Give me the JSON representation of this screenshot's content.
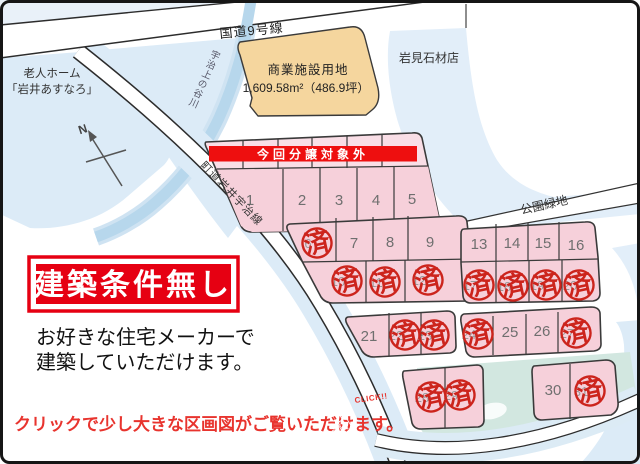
{
  "labels": {
    "route9": "国道9号線",
    "town_road": "町道岩井宇治線",
    "river": "宇治上の谷川",
    "nursing1": "老人ホーム",
    "nursing2": "「岩井あすなろ」",
    "stone_shop": "岩見石材店",
    "park": "公園緑地",
    "commercial_title": "商業施設用地",
    "commercial_area": "1,609.58m²（486.9坪）",
    "banner": "今回分譲対象外",
    "north": "N"
  },
  "promo": {
    "box": "建築条件無し",
    "line1": "お好きな住宅メーカーで",
    "line2": "建築していただけます。"
  },
  "footer": {
    "text": "クリックで少し大きな区画図がご覧いただけます。",
    "click": "CLICK!!"
  },
  "map": {
    "sold_mark": "済",
    "lots": [
      {
        "n": "1",
        "x": 250,
        "y": 200,
        "sold": false
      },
      {
        "n": "2",
        "x": 302,
        "y": 200,
        "sold": false
      },
      {
        "n": "3",
        "x": 339,
        "y": 200,
        "sold": false
      },
      {
        "n": "4",
        "x": 376,
        "y": 200,
        "sold": false
      },
      {
        "n": "5",
        "x": 412,
        "y": 199,
        "sold": false
      },
      {
        "n": "6",
        "x": 317,
        "y": 243,
        "sold": true
      },
      {
        "n": "7",
        "x": 354,
        "y": 243,
        "sold": false
      },
      {
        "n": "8",
        "x": 390,
        "y": 242,
        "sold": false
      },
      {
        "n": "9",
        "x": 430,
        "y": 242,
        "sold": false
      },
      {
        "n": "10",
        "x": 347,
        "y": 281,
        "sold": true
      },
      {
        "n": "11",
        "x": 385,
        "y": 282,
        "sold": true
      },
      {
        "n": "12",
        "x": 428,
        "y": 280,
        "sold": true
      },
      {
        "n": "13",
        "x": 479,
        "y": 244,
        "sold": false
      },
      {
        "n": "14",
        "x": 512,
        "y": 243,
        "sold": false
      },
      {
        "n": "15",
        "x": 543,
        "y": 243,
        "sold": false
      },
      {
        "n": "16",
        "x": 576,
        "y": 245,
        "sold": false
      },
      {
        "n": "17",
        "x": 479,
        "y": 285,
        "sold": true
      },
      {
        "n": "18",
        "x": 513,
        "y": 286,
        "sold": true
      },
      {
        "n": "19",
        "x": 546,
        "y": 285,
        "sold": true
      },
      {
        "n": "20",
        "x": 579,
        "y": 285,
        "sold": true
      },
      {
        "n": "21",
        "x": 369,
        "y": 336,
        "sold": false
      },
      {
        "n": "22",
        "x": 405,
        "y": 335,
        "sold": true
      },
      {
        "n": "23",
        "x": 434,
        "y": 335,
        "sold": true
      },
      {
        "n": "24",
        "x": 478,
        "y": 334,
        "sold": true
      },
      {
        "n": "25",
        "x": 510,
        "y": 332,
        "sold": false
      },
      {
        "n": "26",
        "x": 542,
        "y": 331,
        "sold": false
      },
      {
        "n": "27",
        "x": 576,
        "y": 333,
        "sold": true
      },
      {
        "n": "28",
        "x": 431,
        "y": 397,
        "sold": true
      },
      {
        "n": "29",
        "x": 460,
        "y": 395,
        "sold": true
      },
      {
        "n": "30",
        "x": 553,
        "y": 390,
        "sold": false
      },
      {
        "n": "31",
        "x": 590,
        "y": 391,
        "sold": true
      }
    ]
  },
  "colors": {
    "lot_pink": "#f6d0da",
    "lot_pink_light": "#f9dee6",
    "banner_red": "#ee0f0f",
    "stamp_red": "#cc241c",
    "promo_red": "#e60012",
    "footer_red": "#e8342e",
    "land_blue": "#dcebf7",
    "river_blue": "#b7d7ec",
    "pond_teal": "#d2e7e0",
    "commercial_beige": "#f5d69e"
  }
}
